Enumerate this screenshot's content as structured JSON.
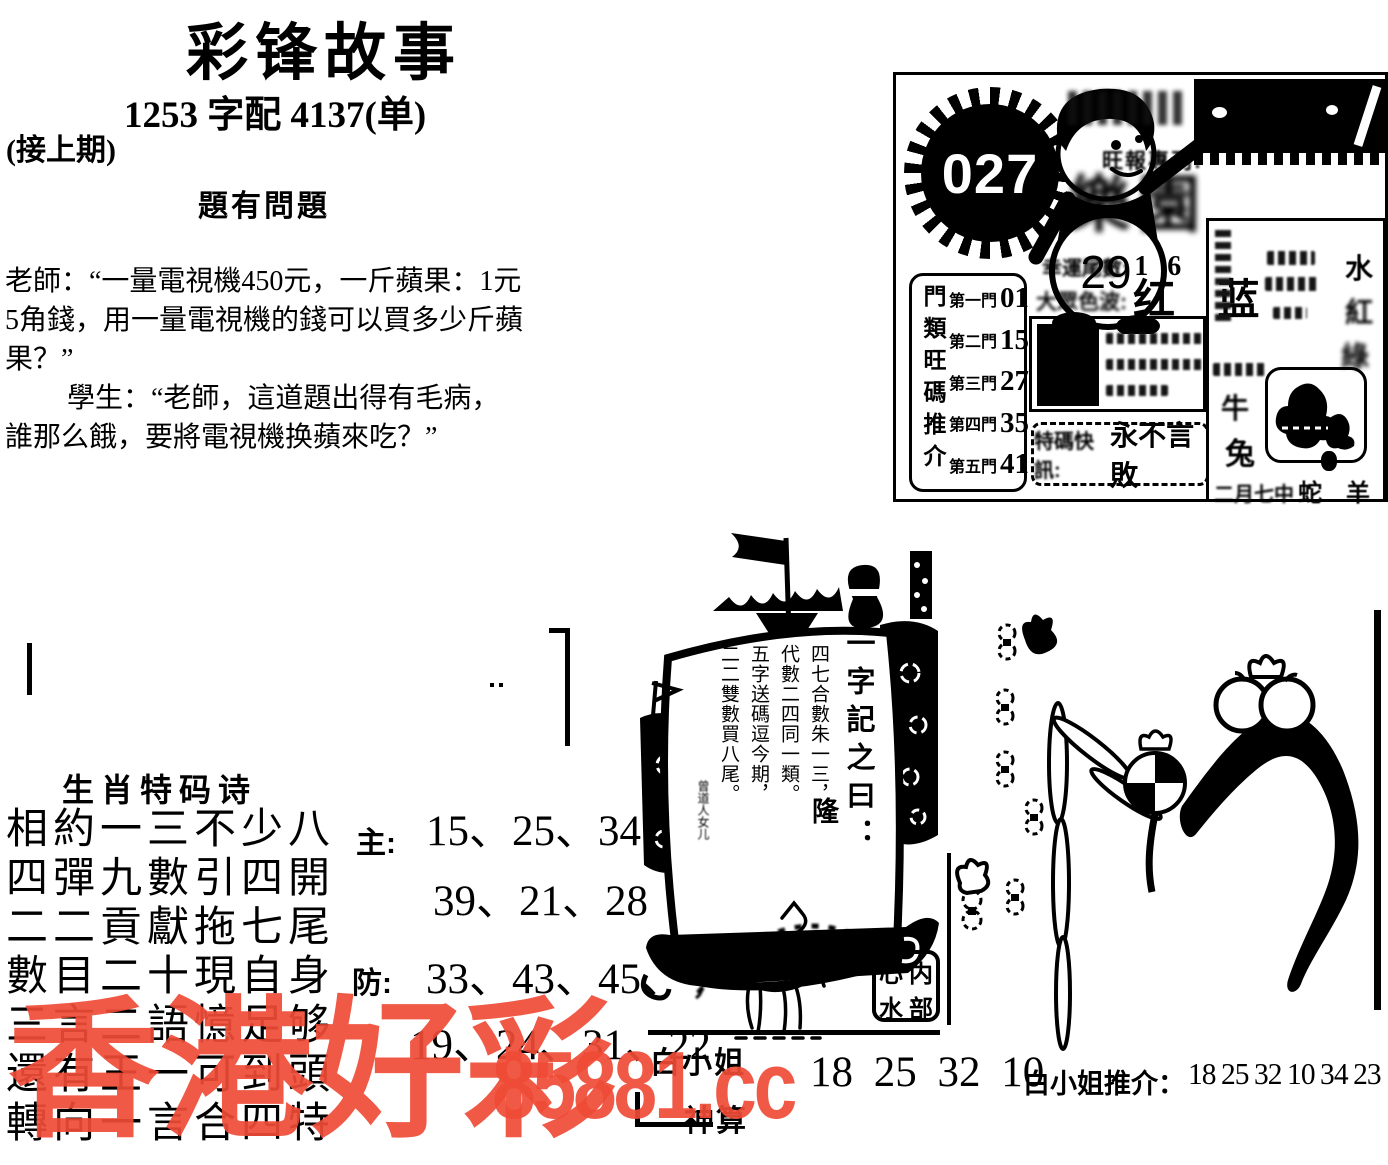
{
  "masthead": {
    "title": "彩锋故事",
    "pairing_line": "1253 字配 4137(单)",
    "continuation_note": "(接上期)",
    "story_heading": "題有問題",
    "story_lines": [
      "老師：“一量電視機450元，一斤蘋果：1元",
      "5角錢，用一量電視機的錢可以買多少斤蘋",
      "果？”",
      "學生：“老師，這道題出得有毛病，",
      "誰那么餓，要將電視機换蘋來吃？”"
    ]
  },
  "issue_box": {
    "issue_number": "027",
    "ball_number": "29",
    "column_label": "旺報專刊:",
    "brand_graphic": "樂園",
    "lucky_tail_label": "幸運尾數:",
    "lucky_tail_value": "1 6",
    "color_wave_label": "大眾色波:",
    "color_wave_value": "红 蓝",
    "special_alert_label": "特碼快訊:",
    "special_alert_value": "永不言敗",
    "door_box": {
      "vertical_label": "門類旺碼推介",
      "rows": [
        {
          "label": "第一門",
          "value": "01"
        },
        {
          "label": "第二門",
          "value": "15"
        },
        {
          "label": "第三門",
          "value": "27"
        },
        {
          "label": "第四門",
          "value": "35"
        },
        {
          "label": "第五門",
          "value": "41"
        }
      ]
    },
    "side_panel": {
      "element_chars": [
        "水",
        "紅",
        "綠"
      ],
      "zodiac_chars": [
        "牛",
        "兔"
      ],
      "month_note": "二月七中",
      "zodiac_pair": "蛇 羊"
    }
  },
  "ship": {
    "motto_label": "一字記之曰：",
    "motto_char": "隆",
    "verse_columns": [
      "四七合數朱一三，",
      "代數二四同一類。",
      "五字送碼逗今期，",
      "二二雙數買八尾。"
    ],
    "signature": "曾道人女儿",
    "stamp_chars": [
      "心",
      "内",
      "水",
      "部"
    ]
  },
  "zodiac_poem": {
    "heading": "生肖特码诗",
    "lines": [
      "相約一三不少八",
      "四彈九數引四開",
      "二二貢獻拖七尾",
      "數目二十現自身",
      "三言二語憶足够",
      "還有王一可到頭",
      "轉向一言合四特"
    ],
    "main_label": "主:",
    "main_row1": "15、25、34",
    "main_row2": "39、21、28",
    "guard_label": "防:",
    "guard_row1": "33、43、45、",
    "guard_row2": "19、24、31、22"
  },
  "bottom_strip": {
    "brand_name": "白小姐",
    "brand_name2": "神算",
    "big_numbers": "18 25 32 10",
    "recommend_label": "白小姐推介：",
    "recommend_numbers": "18 25 32 10 34 23"
  },
  "watermark": {
    "site_name": "香港好彩",
    "site_url": "85881.cc",
    "color": "#ef4b36"
  }
}
